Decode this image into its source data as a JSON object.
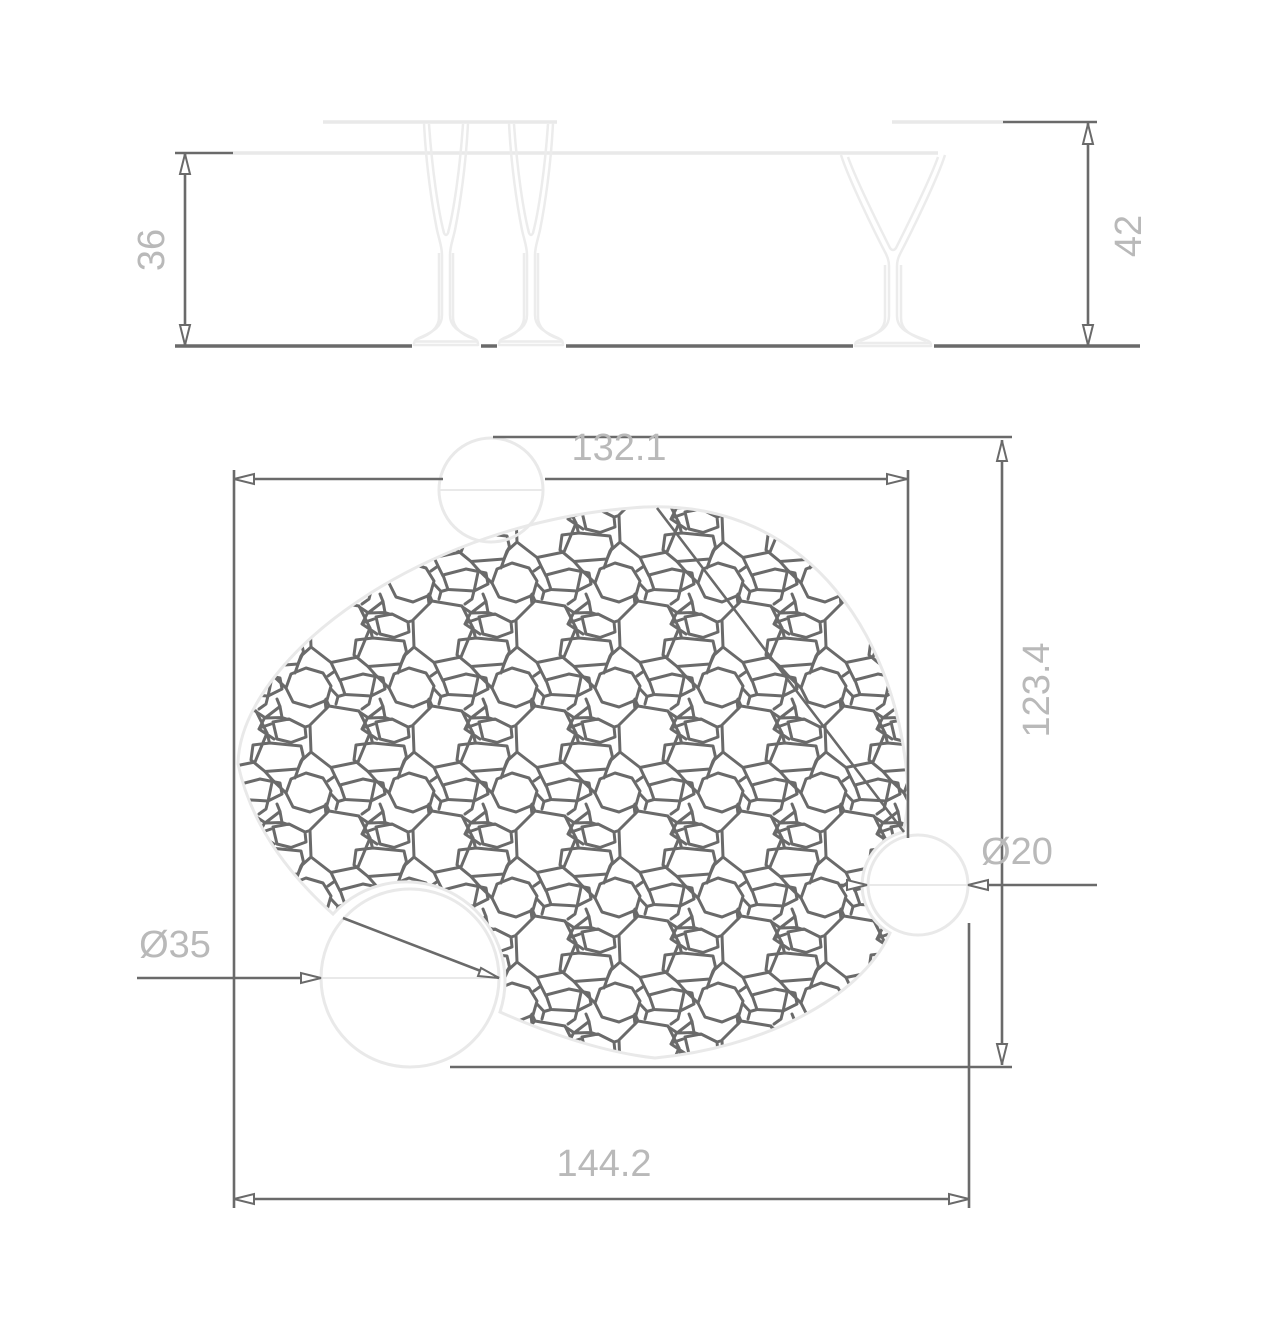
{
  "drawing": {
    "front_view": {
      "height_left": "36",
      "height_right": "42"
    },
    "plan_view": {
      "width_top": "132.1",
      "height_right": "123.4",
      "width_bottom": "144.2",
      "hole_large": "Ø35",
      "hole_small": "Ø20"
    }
  },
  "colors": {
    "dimension_line": "#6a6a6a",
    "label_text": "#b9b9b9",
    "light_outline": "#e9e9e9",
    "background": "#ffffff"
  }
}
